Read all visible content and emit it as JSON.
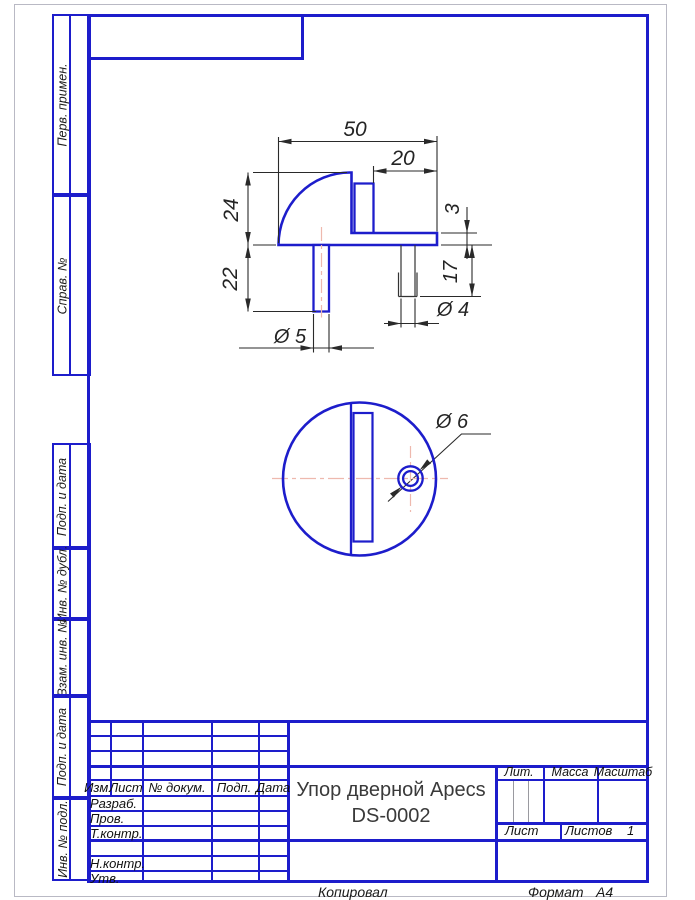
{
  "sheet": {
    "copied_label": "Копировал",
    "format_label": "Формат",
    "format_value": "А4"
  },
  "sidebar": {
    "labels": [
      "Перв. примен.",
      "Справ. №",
      "Подп. и дата",
      "Инв. № дубл.",
      "Взам. инв. №",
      "Подп. и дата",
      "Инв. № подл."
    ]
  },
  "title_block": {
    "rev": [
      "Изм.",
      "Лист",
      "№ докум.",
      "Подп.",
      "Дата"
    ],
    "roles": [
      "Разраб.",
      "Пров.",
      "Т.контр.",
      "Н.контр.",
      "Утв."
    ],
    "title_line1": "Упор дверной Apecs",
    "title_line2": "DS-0002",
    "lit_label": "Лит.",
    "mass_label": "Масса",
    "scale_label": "Масштаб",
    "sheet_label": "Лист",
    "sheets_label": "Листов",
    "sheets_value": "1"
  },
  "drawing": {
    "part_name": "door-stop",
    "dims": {
      "overall_width": "50",
      "step_width": "20",
      "dome_height": "24",
      "pin_length": "22",
      "plate_thickness": "3",
      "screw_length": "17",
      "pin_diameter": "Ø 5",
      "screw_diameter": "Ø 4",
      "hole_diameter": "Ø 6"
    }
  },
  "colors": {
    "line_blue": "#1d1dcb",
    "dim_dark": "#2a2a2a",
    "centerline_pink": "#eeb9ae"
  }
}
